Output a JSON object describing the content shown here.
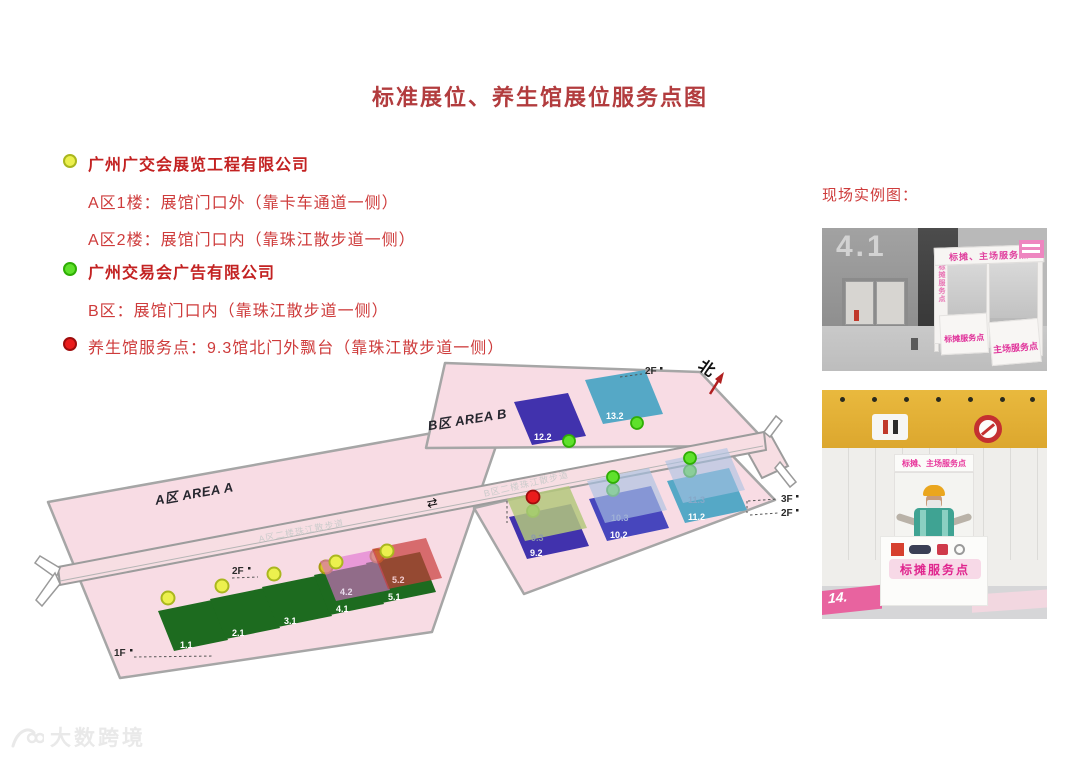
{
  "title": "标准展位、养生馆展位服务点图",
  "legend": {
    "company1": "广州广交会展览工程有限公司",
    "company1_line1": "A区1楼：展馆门口外（靠卡车通道一侧）",
    "company1_line2": "A区2楼：展馆门口内（靠珠江散步道一侧）",
    "company2": "广州交易会广告有限公司",
    "company2_line1": "B区：展馆门口内（靠珠江散步道一侧）",
    "health_line": "养生馆服务点：9.3馆北门外飘台（靠珠江散步道一侧）"
  },
  "examples_heading": "现场实例图：",
  "map": {
    "area_a": "A区 AREA A",
    "area_b": "B区 AREA B",
    "walkway_a": "A区二楼珠江散步道",
    "walkway_b": "B区二楼珠江散步道",
    "north": "北",
    "arrows": "⇄",
    "floors": {
      "a_1f": "1F",
      "a_2f": "2F",
      "b_top_2f": "2F",
      "b_3f": "3F",
      "b_2f": "2F"
    },
    "halls": {
      "h1_1": "1.1",
      "h2_1": "2.1",
      "h3_1": "3.1",
      "h4_1": "4.1",
      "h4_2": "4.2",
      "h5_1": "5.1",
      "h5_2": "5.2",
      "h9_2": "9.2",
      "h9_3": "9.3",
      "h10_2": "10.2",
      "h10_3": "10.3",
      "h11_2": "11.2",
      "h11_3": "11.3",
      "h12_2": "12.2",
      "h13_2": "13.2"
    }
  },
  "photos": {
    "photo1": {
      "wall_number": "4.1",
      "banner": "标摊、主场服务点",
      "side_text": "标摊服务点",
      "counter_left": "标摊服务点",
      "counter_right": "主场服务点"
    },
    "photo2": {
      "banner": "标摊、主场服务点",
      "counter": "标摊服务点",
      "floor_left": "14."
    }
  },
  "watermark": "大数跨境",
  "palette": {
    "title_red": "#b23c3e",
    "legend_red": "#ce3b3b",
    "legend_bold_red": "#c32222",
    "area_pink": "#f8dce4",
    "area_stroke": "#a6a6a6",
    "corridor_pink": "#f7dee3",
    "hall_green": "#1d6b1f",
    "indigo": "#4132ad",
    "indigo_light": "#4746bd",
    "teal": "#55a8c6",
    "olive_overlay": "#b4c87d",
    "steel_overlay": "#a9c2e2",
    "pink_overlay": "#e06cd0",
    "red_overlay": "#c93a3a",
    "dot_yellow": "#ecf04e",
    "dot_hidden_yellow": "#d6c528",
    "dot_green": "#5fe12b",
    "dot_red": "#ea1c1c",
    "booth_pink": "#e0339b"
  }
}
